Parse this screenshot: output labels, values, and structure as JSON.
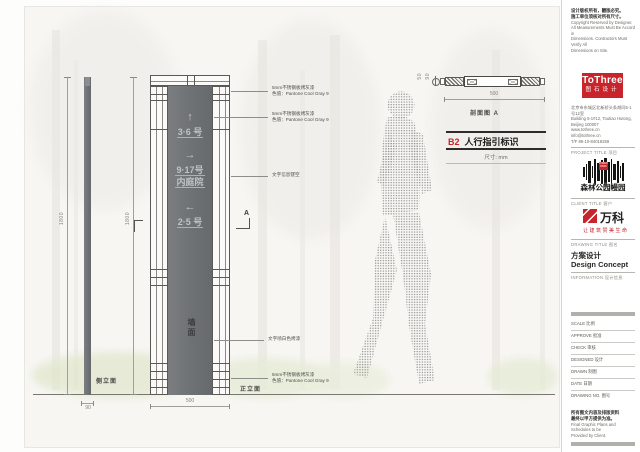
{
  "views": {
    "side": {
      "label": "侧立面",
      "dim_height_left": "1800",
      "dim_height_right": "1800",
      "dim_width": "90"
    },
    "front": {
      "label": "正立面",
      "dim_width": "500",
      "wall_text": "墙面",
      "section_letter": "A",
      "entries": [
        {
          "arrow": "↑",
          "line1": "3·6 号",
          "line2": ""
        },
        {
          "arrow": "→",
          "line1": "9·17号",
          "line2": "内庭院"
        },
        {
          "arrow": "←",
          "line1": "2·5 号",
          "line2": ""
        }
      ]
    },
    "section": {
      "label": "剖面图 A",
      "dim_width": "500",
      "bolt_dim_a": "50",
      "bolt_dim_b": "90"
    }
  },
  "annotations": [
    {
      "l1": "5mm不锈钢板烤灰漆",
      "l2": "色值：Pantone Cool Gray 9"
    },
    {
      "l1": "5mm不锈钢板烤灰漆",
      "l2": "色值：Pantone Cool Gray 9"
    },
    {
      "l1": "文字信息镂空",
      "l2": ""
    },
    {
      "l1": "文字喷白色烤漆",
      "l2": ""
    },
    {
      "l1": "5mm不锈钢板烤灰漆",
      "l2": "色值：Pantone Cool Gray 9"
    }
  ],
  "title": {
    "code": "B2",
    "name": "人行指引标识",
    "unit": "尺寸: mm"
  },
  "titleblock": {
    "copyright_cn1": "设计版权所有，翻版必究。",
    "copyright_cn2": "施工单位须核对所有尺寸。",
    "copyright_en1": "Copyright Reserved by Designer.",
    "copyright_en2": "All Measurements Must Be Accord in",
    "copyright_en3": "Dimensions. Contractors Must Verify All",
    "copyright_en4": "Dimensions on Site.",
    "logo_name": "ToThree",
    "logo_sub": "图石设计",
    "addr1": "北京市东城区北新桥头条胡同5-1号12室",
    "addr2": "Building 5-1#12, Toutiao Hutong,",
    "addr3": "Beijing 100007",
    "addr4": "www.tothree.cn",
    "addr5": "info@tothree.cn",
    "addr6": "T/F 86-10-84018258",
    "project_header": "PROJECT TITLE 项目",
    "project_logo_tag": "FOREST PARK",
    "project_name": "森林公园幔园",
    "client_header": "CLIENT TITLE 客户",
    "client_name": "万科",
    "client_slogan": "让建筑赞美生命",
    "drawing_header": "DRAWING TITLE 图名",
    "drawing_cn": "方案设计",
    "drawing_en": "Design Concept",
    "info_header": "INFORMATION 设计信息",
    "fields": [
      "SCALE 比例",
      "APPROVE 批准",
      "CHECK 审核",
      "DESIGNED 设计",
      "DRAWN 制图",
      "DATE 日期",
      "DRAWING NO. 图号"
    ],
    "note_cn1": "所有图文内容及排版资料",
    "note_cn2": "最终以甲方提供为准。",
    "note_en1": "Final Graphic Plans and Schedules to be",
    "note_en2": "Provided by Client."
  },
  "colors": {
    "accent_red": "#c8242b",
    "panel_gray": "#6f7275"
  }
}
